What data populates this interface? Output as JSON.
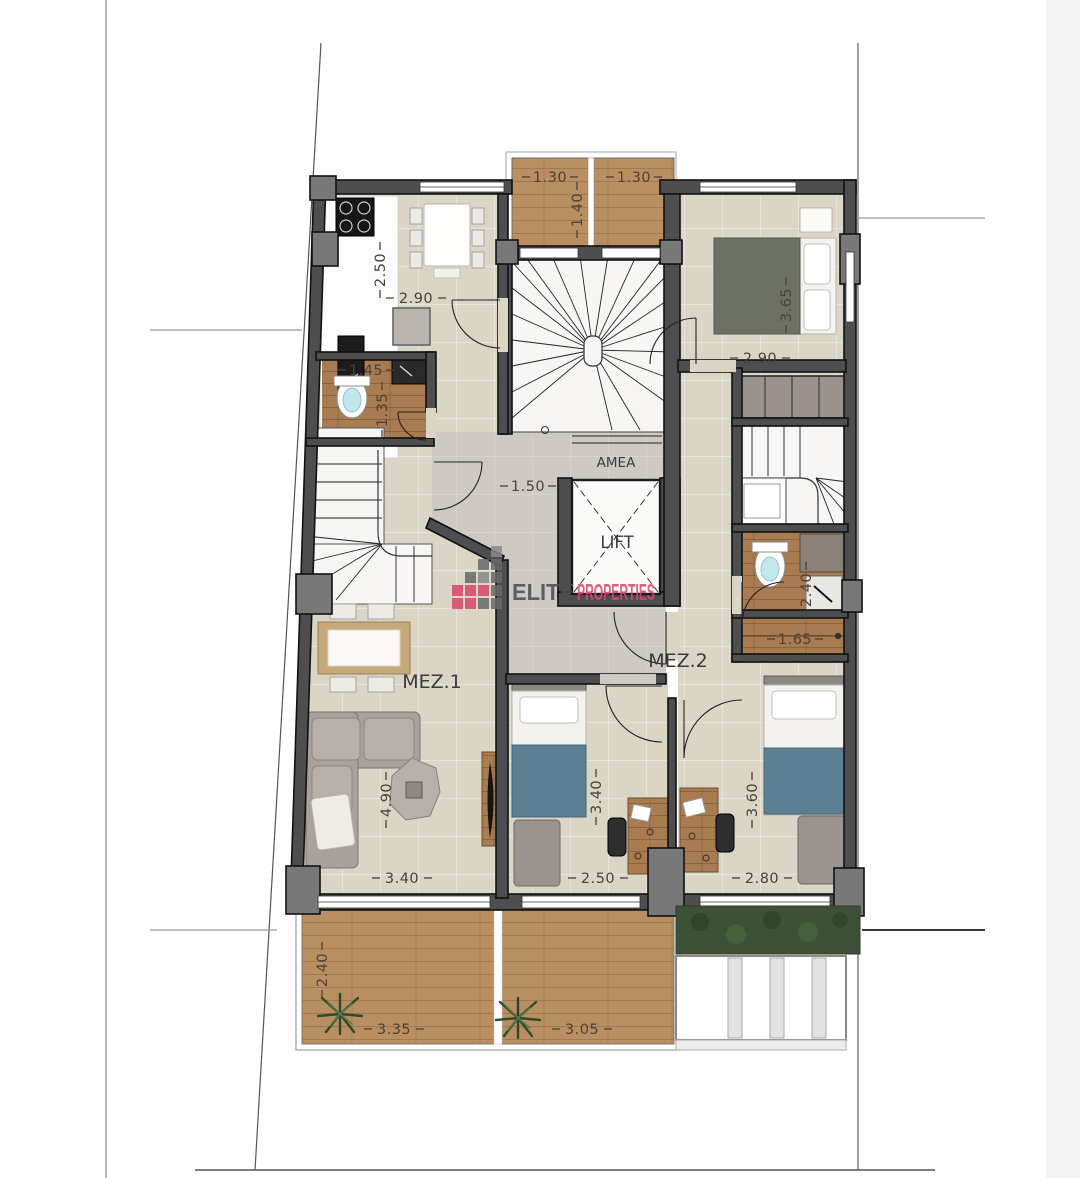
{
  "plan": {
    "title": "Mezzanine floor plan",
    "units": {
      "mez1": "MEZ.1",
      "mez2": "MEZ.2"
    },
    "core": {
      "amea": "AMEA",
      "lift": "LIFT"
    },
    "dims": {
      "balcony_left": "1.30",
      "balcony_right": "1.30",
      "balcony_depth": "1.40",
      "kitchen_depth": "2.50",
      "kitchen_width": "2.90",
      "bath1_width": "1.45",
      "bath1_depth": "1.35",
      "master_depth": "3.65",
      "master_width": "2.90",
      "hall_width": "1.50",
      "bath2_depth": "2.40",
      "closet_width": "1.65",
      "living_depth": "4.90",
      "living_width": "3.40",
      "bed1_depth": "3.40",
      "bed1_width": "2.50",
      "bed2_depth": "3.60",
      "bed2_width": "2.80",
      "terrace_depth": "2.40",
      "terrace1_width": "3.35",
      "terrace2_width": "3.05"
    },
    "branding": {
      "elite": "ELITE",
      "properties": "PROPERTIES"
    },
    "colors": {
      "wall": "#4e4e50",
      "floor_tile": "#dbd5c6",
      "hall_marble": "#cfc9c3",
      "wood_deck": "#b98f62",
      "wood_dark": "#a87c50",
      "stair_white": "#f7f6f4",
      "bed_blue": "#5d7f93",
      "bed_green": "#6d7165",
      "sofa_gray": "#a9a19c",
      "hedge_green": "#3c5136",
      "logo_pink": "#d9486b",
      "logo_gray": "#4c4c4c"
    }
  }
}
